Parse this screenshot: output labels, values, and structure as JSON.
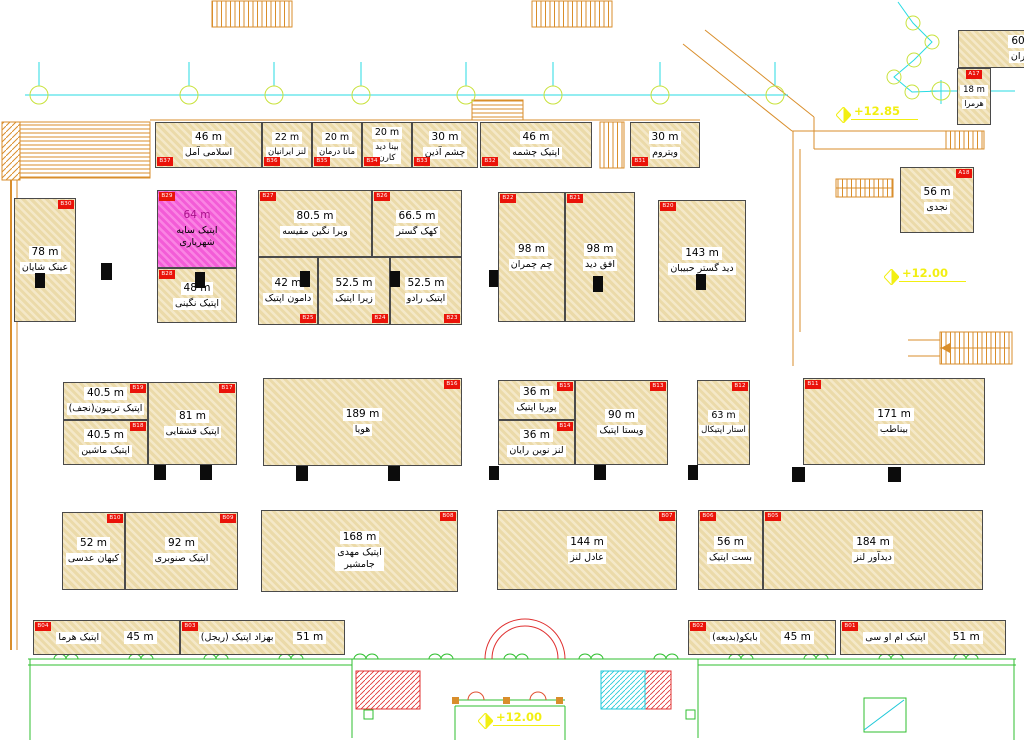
{
  "colors": {
    "unit_fill": "#f0e2bb",
    "unit_outline": "#4a4a4a",
    "highlight_pink": "#f35cd7",
    "tag_red": "#ea1309",
    "grid_cyan": "#27dbe3",
    "grid_bubble_green": "#c9e23c",
    "wall_orange": "#d98e2b",
    "entrance_green": "#2fbf2f",
    "entrance_red": "#e03030",
    "elevation_yellow": "#f2ef12"
  },
  "elevations": [
    {
      "label": "+12.85",
      "x": 836,
      "y": 104
    },
    {
      "label": "+12.00",
      "x": 884,
      "y": 266
    },
    {
      "label": "+12.00",
      "x": 478,
      "y": 710
    }
  ],
  "units": [
    {
      "tag": "B37",
      "area": "46 m",
      "name": "اسلامی آمل",
      "x": 155,
      "y": 122,
      "w": 107,
      "h": 46,
      "tagPos": "bl"
    },
    {
      "tag": "B36",
      "area": "22 m",
      "name": "لنز ایرانیان",
      "x": 262,
      "y": 122,
      "w": 50,
      "h": 46,
      "tagPos": "bl"
    },
    {
      "tag": "B35",
      "area": "20 m",
      "name": "مانا درمان",
      "x": 312,
      "y": 122,
      "w": 50,
      "h": 46,
      "tagPos": "bl"
    },
    {
      "tag": "B34",
      "area": "20 m",
      "name": "بینا دید\nکارن",
      "x": 362,
      "y": 122,
      "w": 50,
      "h": 46,
      "tagPos": "bl"
    },
    {
      "tag": "B33",
      "area": "30 m",
      "name": "چشم آذین",
      "x": 412,
      "y": 122,
      "w": 66,
      "h": 46,
      "tagPos": "bl"
    },
    {
      "tag": "B32",
      "area": "46 m",
      "name": "اپتیک چشمه",
      "x": 480,
      "y": 122,
      "w": 112,
      "h": 46,
      "tagPos": "bl"
    },
    {
      "tag": "B31",
      "area": "30 m",
      "name": "ویتروم",
      "x": 630,
      "y": 122,
      "w": 70,
      "h": 46,
      "tagPos": "bl"
    },
    {
      "tag": "B30",
      "area": "78 m",
      "name": "عینک شایان",
      "x": 14,
      "y": 198,
      "w": 62,
      "h": 124,
      "tagPos": "tr"
    },
    {
      "tag": "B29",
      "area": "64 m",
      "name": "اپتیک سایه شهریاری",
      "x": 157,
      "y": 190,
      "w": 80,
      "h": 78,
      "tagPos": "tl",
      "fill": "pink"
    },
    {
      "tag": "B28",
      "area": "48 m",
      "name": "اپتیک نگینی",
      "x": 157,
      "y": 268,
      "w": 80,
      "h": 55,
      "tagPos": "tl"
    },
    {
      "tag": "B27",
      "area": "80.5 m",
      "name": "ویرا نگین مقیسه",
      "x": 258,
      "y": 190,
      "w": 114,
      "h": 67,
      "tagPos": "tl"
    },
    {
      "tag": "B26",
      "area": "66.5 m",
      "name": "کهک گستر",
      "x": 372,
      "y": 190,
      "w": 90,
      "h": 67,
      "tagPos": "tl"
    },
    {
      "tag": "B25",
      "area": "42 m",
      "name": "دامون اپتیک",
      "x": 258,
      "y": 257,
      "w": 60,
      "h": 68,
      "tagPos": "br"
    },
    {
      "tag": "B24",
      "area": "52.5 m",
      "name": "زیرا اپتیک",
      "x": 318,
      "y": 257,
      "w": 72,
      "h": 68,
      "tagPos": "br"
    },
    {
      "tag": "B23",
      "area": "52.5 m",
      "name": "اپتیک رادو",
      "x": 390,
      "y": 257,
      "w": 72,
      "h": 68,
      "tagPos": "br"
    },
    {
      "tag": "B22",
      "area": "98 m",
      "name": "چم چمران",
      "x": 498,
      "y": 192,
      "w": 67,
      "h": 130,
      "tagPos": "tl"
    },
    {
      "tag": "B21",
      "area": "98 m",
      "name": "افق دید",
      "x": 565,
      "y": 192,
      "w": 70,
      "h": 130,
      "tagPos": "tl"
    },
    {
      "tag": "B20",
      "area": "143 m",
      "name": "دید گستر حبیبان",
      "x": 658,
      "y": 200,
      "w": 88,
      "h": 122,
      "tagPos": "tl"
    },
    {
      "tag": "B19",
      "area": "40.5 m",
      "name": "اپتیک تریبون(نجف)",
      "x": 63,
      "y": 382,
      "w": 85,
      "h": 38,
      "tagPos": "tr"
    },
    {
      "tag": "B18",
      "area": "40.5 m",
      "name": "اپتیک ماشین",
      "x": 63,
      "y": 420,
      "w": 85,
      "h": 45,
      "tagPos": "tr"
    },
    {
      "tag": "B17",
      "area": "81 m",
      "name": "اپتیک قشقایی",
      "x": 148,
      "y": 382,
      "w": 89,
      "h": 83,
      "tagPos": "tr"
    },
    {
      "tag": "B16",
      "area": "189 m",
      "name": "هویا",
      "x": 263,
      "y": 378,
      "w": 199,
      "h": 88,
      "tagPos": "tr"
    },
    {
      "tag": "B15",
      "area": "36 m",
      "name": "پوریا اپتیک",
      "x": 498,
      "y": 380,
      "w": 77,
      "h": 40,
      "tagPos": "tr"
    },
    {
      "tag": "B14",
      "area": "36 m",
      "name": "لنز نوین رایان",
      "x": 498,
      "y": 420,
      "w": 77,
      "h": 45,
      "tagPos": "tr"
    },
    {
      "tag": "B13",
      "area": "90 m",
      "name": "ویستا اپتیک",
      "x": 575,
      "y": 380,
      "w": 93,
      "h": 85,
      "tagPos": "tr"
    },
    {
      "tag": "B12",
      "area": "63 m",
      "name": "استار اپتیکال",
      "x": 697,
      "y": 380,
      "w": 53,
      "h": 85,
      "tagPos": "tr"
    },
    {
      "tag": "B11",
      "area": "171 m",
      "name": "بیناطب",
      "x": 803,
      "y": 378,
      "w": 182,
      "h": 87,
      "tagPos": "tl"
    },
    {
      "tag": "B10",
      "area": "52 m",
      "name": "کیهان عدسی",
      "x": 62,
      "y": 512,
      "w": 63,
      "h": 78,
      "tagPos": "tr"
    },
    {
      "tag": "B09",
      "area": "92 m",
      "name": "اپتیک صنوبری",
      "x": 125,
      "y": 512,
      "w": 113,
      "h": 78,
      "tagPos": "tr"
    },
    {
      "tag": "B08",
      "area": "168 m",
      "name": "اپتیک مهدی\nجامشیر",
      "x": 261,
      "y": 510,
      "w": 197,
      "h": 82,
      "tagPos": "tr"
    },
    {
      "tag": "B07",
      "area": "144 m",
      "name": "عادل لنز",
      "x": 497,
      "y": 510,
      "w": 180,
      "h": 80,
      "tagPos": "tr"
    },
    {
      "tag": "B06",
      "area": "56 m",
      "name": "بست اپتیک",
      "x": 698,
      "y": 510,
      "w": 65,
      "h": 80,
      "tagPos": "tl"
    },
    {
      "tag": "B05",
      "area": "184 m",
      "name": "دیدآور لنز",
      "x": 763,
      "y": 510,
      "w": 220,
      "h": 80,
      "tagPos": "tl"
    },
    {
      "tag": "B04",
      "area": "45 m",
      "name": "اپتیک هرما",
      "x": 33,
      "y": 620,
      "w": 147,
      "h": 35,
      "tagPos": "tl",
      "layout": "row"
    },
    {
      "tag": "B03",
      "area": "51 m",
      "name": "بهزاد اپتیک (ریجل)",
      "x": 180,
      "y": 620,
      "w": 165,
      "h": 35,
      "tagPos": "tl",
      "layout": "row"
    },
    {
      "tag": "B02",
      "area": "45 m",
      "name": "بایکو(بدیعه)",
      "x": 688,
      "y": 620,
      "w": 148,
      "h": 35,
      "tagPos": "tl",
      "layout": "row"
    },
    {
      "tag": "B01",
      "area": "51 m",
      "name": "اپتیک ام او سی",
      "x": 840,
      "y": 620,
      "w": 166,
      "h": 35,
      "tagPos": "tl",
      "layout": "row"
    },
    {
      "tag": "A17",
      "area": "18 m",
      "name": "هرمرا",
      "x": 957,
      "y": 68,
      "w": 34,
      "h": 57,
      "tagPos": "tc"
    },
    {
      "tag": "A18",
      "area": "56 m",
      "name": "نجدی",
      "x": 900,
      "y": 167,
      "w": 74,
      "h": 66,
      "tagPos": "tr"
    },
    {
      "tag": "",
      "area": "60",
      "name": "ران",
      "x": 958,
      "y": 30,
      "w": 120,
      "h": 38,
      "tagPos": ""
    }
  ],
  "doors": [
    {
      "x": 35,
      "y": 273,
      "w": 10,
      "h": 15
    },
    {
      "x": 101,
      "y": 263,
      "w": 11,
      "h": 17
    },
    {
      "x": 195,
      "y": 272,
      "w": 10,
      "h": 16
    },
    {
      "x": 300,
      "y": 271,
      "w": 10,
      "h": 16
    },
    {
      "x": 390,
      "y": 271,
      "w": 10,
      "h": 16
    },
    {
      "x": 489,
      "y": 270,
      "w": 9,
      "h": 17
    },
    {
      "x": 593,
      "y": 276,
      "w": 10,
      "h": 16
    },
    {
      "x": 696,
      "y": 274,
      "w": 10,
      "h": 16
    },
    {
      "x": 154,
      "y": 465,
      "w": 12,
      "h": 15
    },
    {
      "x": 200,
      "y": 465,
      "w": 12,
      "h": 15
    },
    {
      "x": 296,
      "y": 466,
      "w": 12,
      "h": 15
    },
    {
      "x": 388,
      "y": 466,
      "w": 12,
      "h": 15
    },
    {
      "x": 489,
      "y": 466,
      "w": 10,
      "h": 14
    },
    {
      "x": 594,
      "y": 465,
      "w": 12,
      "h": 15
    },
    {
      "x": 688,
      "y": 465,
      "w": 10,
      "h": 15
    },
    {
      "x": 792,
      "y": 467,
      "w": 13,
      "h": 15
    },
    {
      "x": 888,
      "y": 467,
      "w": 13,
      "h": 15
    }
  ]
}
